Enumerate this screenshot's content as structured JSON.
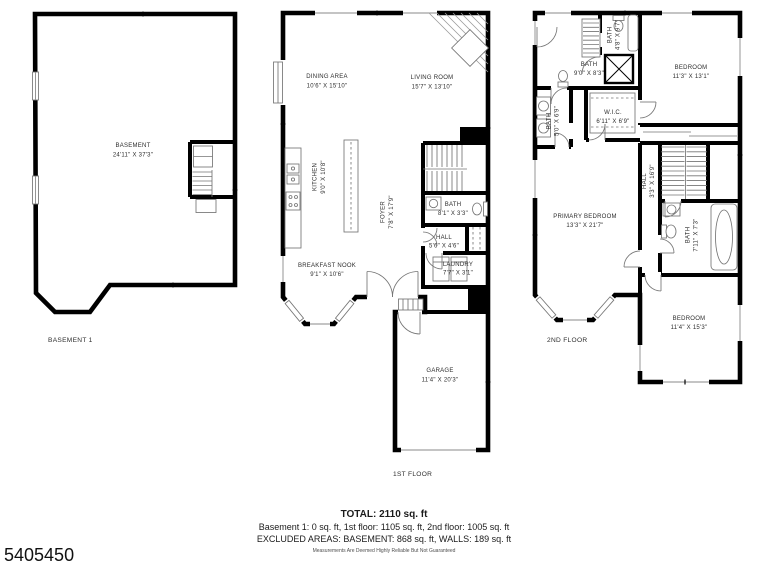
{
  "photo_id": "5405450",
  "colors": {
    "walls": "#000000",
    "details": "#757575",
    "text": "#2e2e2e"
  },
  "plans": {
    "basement": {
      "floor_label": "BASEMENT 1",
      "rooms": {
        "basement": {
          "name": "BASEMENT",
          "dims": "24'11\" X 37'3\""
        }
      }
    },
    "first": {
      "floor_label": "1ST FLOOR",
      "rooms": {
        "dining": {
          "name": "DINING AREA",
          "dims": "10'6\" X 15'10\""
        },
        "living": {
          "name": "LIVING ROOM",
          "dims": "15'7\" X 13'10\""
        },
        "kitchen": {
          "name": "KITCHEN",
          "dims": "9'0\" X 10'8\""
        },
        "foyer": {
          "name": "FOYER",
          "dims": "7'8\" X 17'9\""
        },
        "bath": {
          "name": "BATH",
          "dims": "8'1\" X 3'3\""
        },
        "hall": {
          "name": "HALL",
          "dims": "5'6\" X 4'6\""
        },
        "laundry": {
          "name": "LAUNDRY",
          "dims": "7'7\" X 3'1\""
        },
        "breakfast_nook": {
          "name": "BREAKFAST NOOK",
          "dims": "9'1\" X 10'6\""
        },
        "garage": {
          "name": "GARAGE",
          "dims": "11'4\" X 20'3\""
        }
      }
    },
    "second": {
      "floor_label": "2ND FLOOR",
      "rooms": {
        "bath_top": {
          "name": "BATH",
          "dims": "9'0\" X 8'3\""
        },
        "bath_small": {
          "name": "BATH",
          "dims": "4'8\" X 9'7\""
        },
        "bedroom_top": {
          "name": "BEDROOM",
          "dims": "11'3\" X 13'1\""
        },
        "bath_left": {
          "name": "BATH",
          "dims": "5'0\" X 6'9\""
        },
        "wic": {
          "name": "W.I.C.",
          "dims": "6'11\" X 6'9\""
        },
        "primary_bedroom": {
          "name": "PRIMARY BEDROOM",
          "dims": "13'3\" X 21'7\""
        },
        "hall": {
          "name": "HALL",
          "dims": "3'3\" X 16'9\""
        },
        "bath_mid": {
          "name": "BATH",
          "dims": "7'11\" X 7'3\""
        },
        "bedroom_bottom": {
          "name": "BEDROOM",
          "dims": "11'4\" X 15'3\""
        }
      }
    }
  },
  "summary": {
    "total": "TOTAL: 2110 sq. ft",
    "floors_line": "Basement 1: 0 sq. ft, 1st floor: 1105 sq. ft, 2nd floor: 1005 sq. ft",
    "excluded_line": "EXCLUDED AREAS: BASEMENT: 868 sq. ft, WALLS: 189 sq. ft",
    "disclaimer": "Measurements Are Deemed Highly Reliable But Not Guaranteed"
  }
}
